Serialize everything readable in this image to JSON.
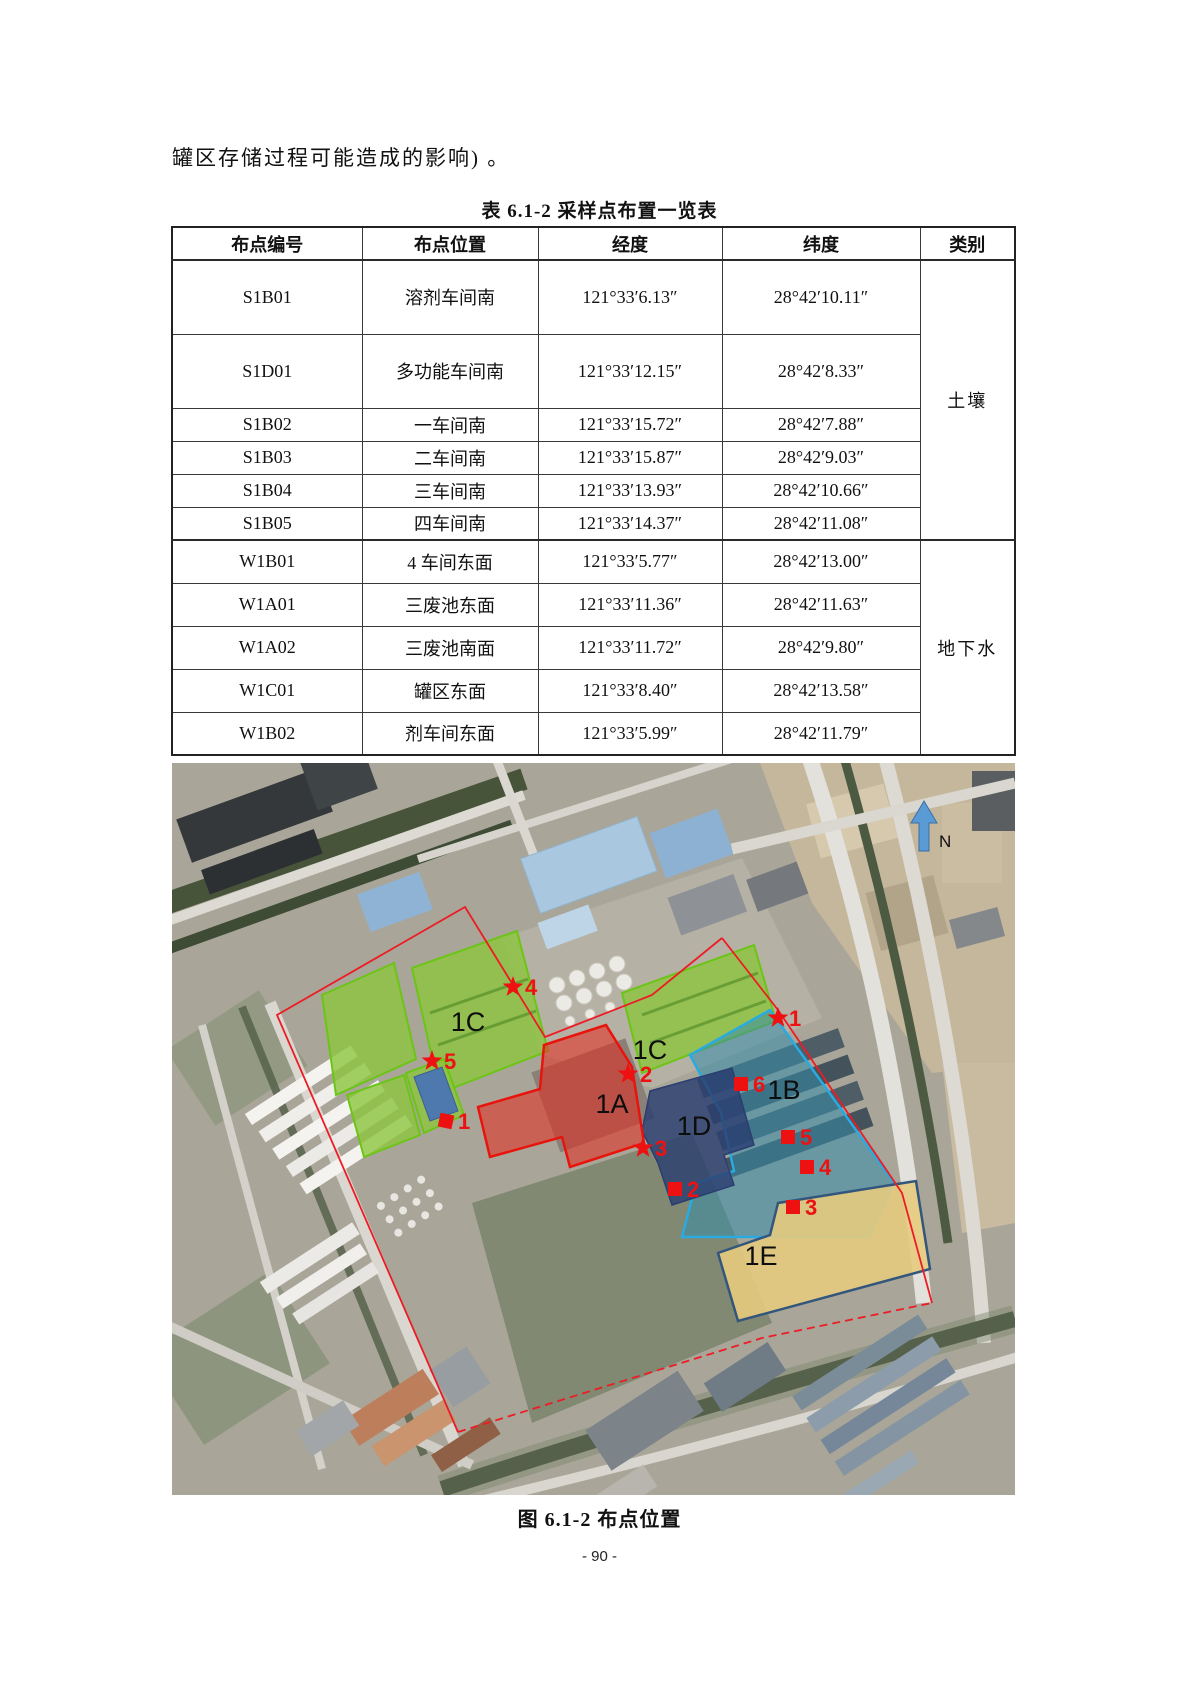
{
  "document": {
    "intro_text": "罐区存储过程可能造成的影响) 。",
    "page_number": "- 90 -"
  },
  "table": {
    "title": "表 6.1-2 采样点布置一览表",
    "headers": {
      "id": "布点编号",
      "location": "布点位置",
      "longitude": "经度",
      "latitude": "纬度",
      "category": "类别"
    },
    "rows": [
      {
        "id": "S1B01",
        "location": "溶剂车间南",
        "longitude": "121°33′6.13″",
        "latitude": "28°42′10.11″"
      },
      {
        "id": "S1D01",
        "location": "多功能车间南",
        "longitude": "121°33′12.15″",
        "latitude": "28°42′8.33″"
      },
      {
        "id": "S1B02",
        "location": "一车间南",
        "longitude": "121°33′15.72″",
        "latitude": "28°42′7.88″"
      },
      {
        "id": "S1B03",
        "location": "二车间南",
        "longitude": "121°33′15.87″",
        "latitude": "28°42′9.03″"
      },
      {
        "id": "S1B04",
        "location": "三车间南",
        "longitude": "121°33′13.93″",
        "latitude": "28°42′10.66″"
      },
      {
        "id": "S1B05",
        "location": "四车间南",
        "longitude": "121°33′14.37″",
        "latitude": "28°42′11.08″"
      },
      {
        "id": "W1B01",
        "location": "4 车间东面",
        "longitude": "121°33′5.77″",
        "latitude": "28°42′13.00″"
      },
      {
        "id": "W1A01",
        "location": "三废池东面",
        "longitude": "121°33′11.36″",
        "latitude": "28°42′11.63″"
      },
      {
        "id": "W1A02",
        "location": "三废池南面",
        "longitude": "121°33′11.72″",
        "latitude": "28°42′9.80″"
      },
      {
        "id": "W1C01",
        "location": "罐区东面",
        "longitude": "121°33′8.40″",
        "latitude": "28°42′13.58″"
      },
      {
        "id": "W1B02",
        "location": "剂车间东面",
        "longitude": "121°33′5.99″",
        "latitude": "28°42′11.79″"
      }
    ],
    "soil_category": "土壤",
    "groundwater_category": "地下水"
  },
  "figure": {
    "caption": "图 6.1-2 布点位置",
    "north_label": "N",
    "region_labels": {
      "r1c_left": "1C",
      "r1c_right": "1C",
      "r1a": "1A",
      "r1b": "1B",
      "r1d": "1D",
      "r1e": "1E"
    },
    "soil_point_labels": [
      "1",
      "2",
      "3",
      "4",
      "5"
    ],
    "groundwater_point_labels": [
      "1",
      "2",
      "3",
      "4",
      "5",
      "6"
    ],
    "colors": {
      "site_boundary": "#ed1c24",
      "marker": "#ee1111",
      "region_1a": "#e8140c",
      "region_1b": "#29abe2",
      "region_1c": "#6cc417",
      "region_1d": "#2b3e70",
      "region_1e": "#e3c87e",
      "north_arrow": "#5b9bd5"
    }
  }
}
